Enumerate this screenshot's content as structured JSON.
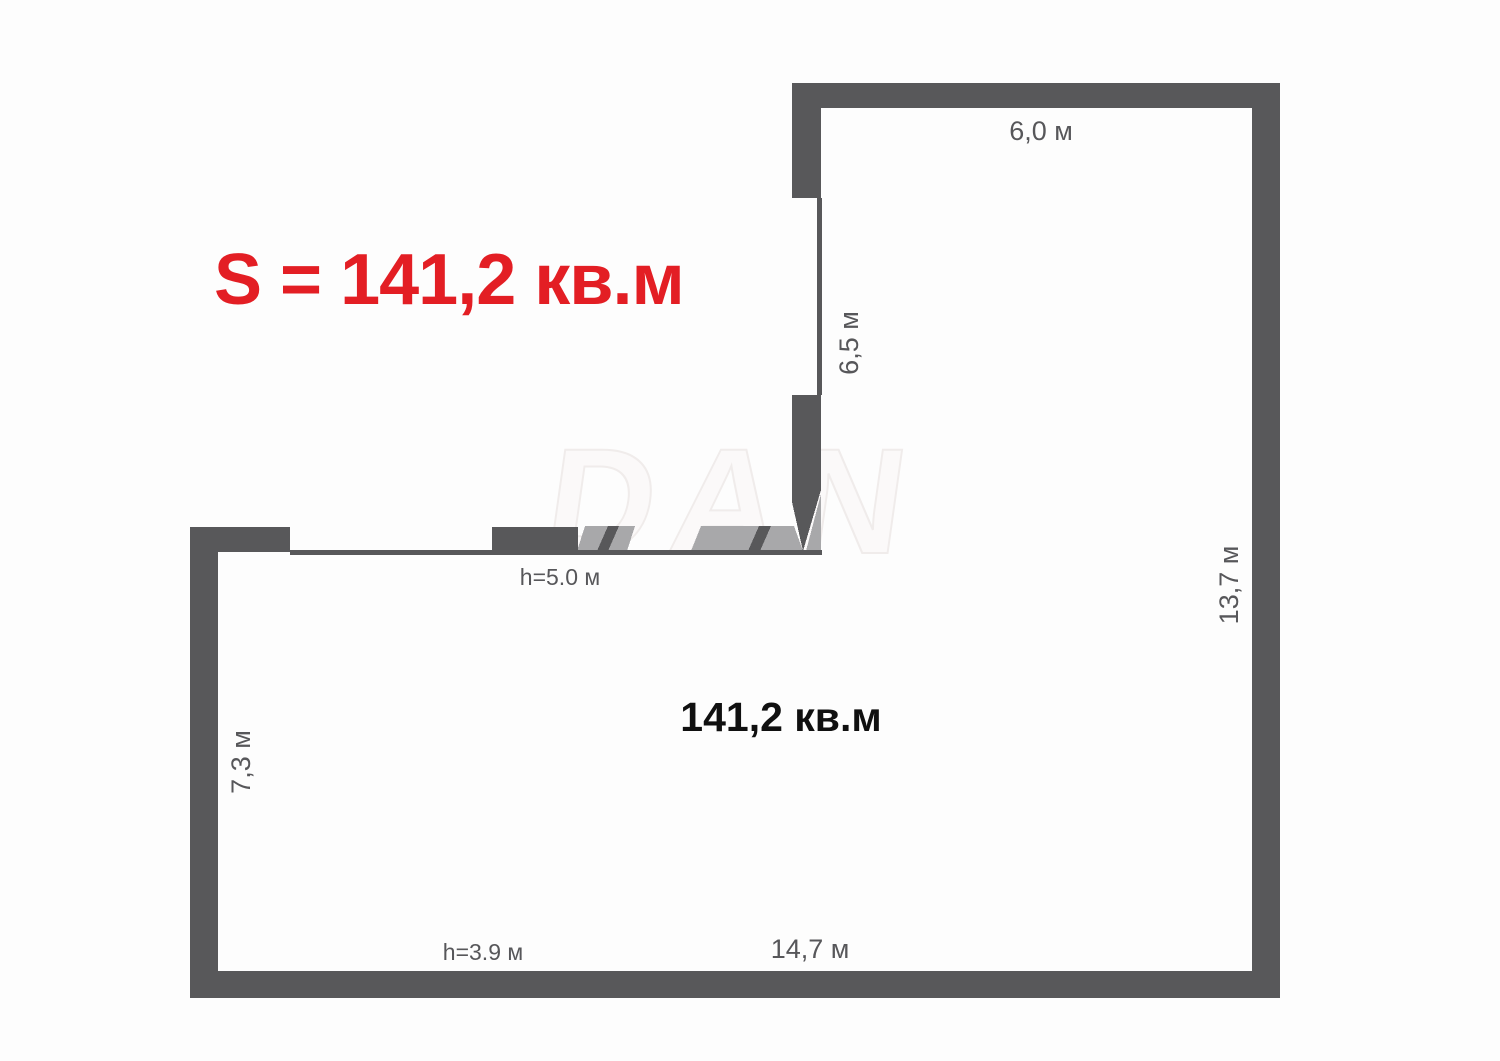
{
  "title": {
    "label": "S = 141,2 кв.м"
  },
  "watermark": {
    "label": "DAN"
  },
  "room": {
    "area_label": "141,2 кв.м"
  },
  "dimensions": {
    "top_width": "6,0 м",
    "niche_height": "6,5 м",
    "right_height": "13,7 м",
    "left_height": "7,3 м",
    "bottom_width": "14,7 м",
    "ceiling_height_upper": "h=5.0 м",
    "ceiling_height_lower": "h=3.9 м"
  },
  "colors": {
    "wall": "#58585a",
    "opening": "#a8a8aa",
    "background": "#fdfdfd",
    "accent_red": "#e31e24",
    "dimension_text": "#57575a",
    "area_text": "#101010"
  }
}
